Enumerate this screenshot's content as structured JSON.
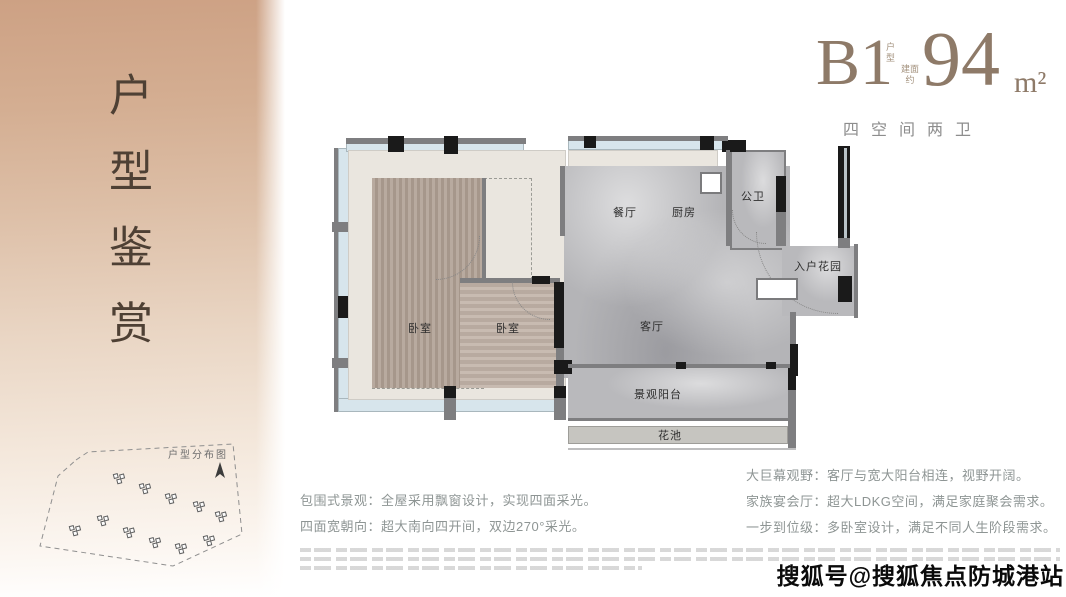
{
  "sidebar": {
    "vertical_title": "户型鉴赏"
  },
  "header": {
    "unit_code": "B1",
    "unit_code_suffix": "户型",
    "area_prefix": "建面约",
    "area_value": "94",
    "area_unit": "m²",
    "subtitle": "四空间两卫"
  },
  "floorplan": {
    "rooms": {
      "dining": "餐厅",
      "kitchen": "厨房",
      "bath": "公卫",
      "entry_garden": "入户花园",
      "bedroom1": "卧室",
      "bedroom2": "卧室",
      "living": "客厅",
      "balcony": "景观阳台",
      "flower_bed": "花池"
    }
  },
  "siteplan": {
    "label": "户型分布图"
  },
  "features": {
    "left": [
      "包围式景观：全屋采用飘窗设计，实现四面采光。",
      "四面宽朝向：超大南向四开间，双边270°采光。"
    ],
    "right": [
      "大巨幕观野：客厅与宽大阳台相连，视野开阔。",
      "家族宴会厅：超大LDKG空间，满足家庭聚会需求。",
      "一步到位级：多卧室设计，满足不同人生阶段需求。"
    ]
  },
  "watermark": {
    "text": "搜狐号@搜狐焦点防城港站"
  },
  "colors": {
    "panel_tan": "#cda184",
    "title_brown": "#8e7a68",
    "feature_gray": "#8e9594",
    "wall_gray": "#7e7e80",
    "window_blue": "#d7e5ec",
    "wood": "#b0a094",
    "marble": "#b4b4b7"
  }
}
